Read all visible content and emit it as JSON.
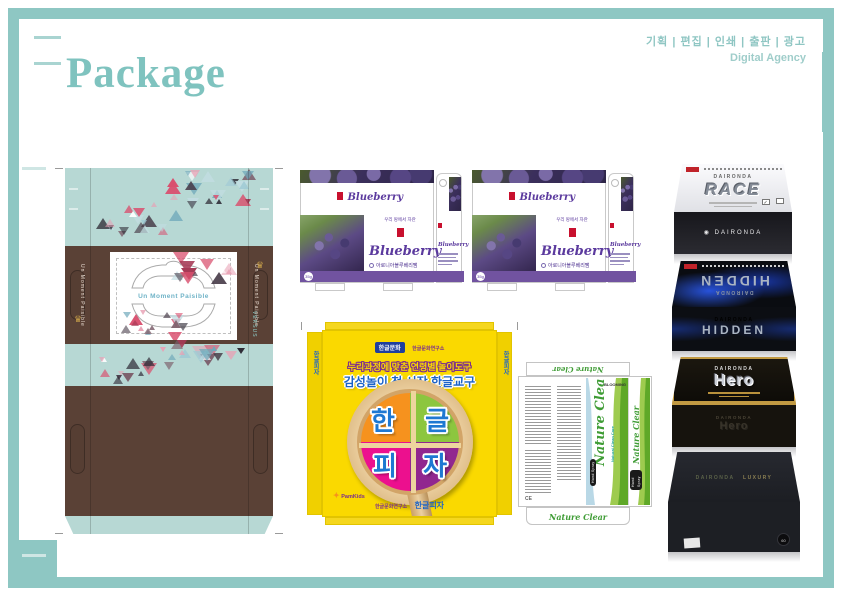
{
  "header": {
    "title": "Package",
    "services": "기획 | 편집 | 인쇄 | 출판 | 광고",
    "agency": "Digital Agency"
  },
  "palette": {
    "frame": "#8ec7c3",
    "brown": "#5a4136",
    "mint": "#b7d8d4",
    "purple": "#7153a0",
    "yellow": "#fad900",
    "triangle_colors": [
      "#d94f6e",
      "#a63a56",
      "#463a47",
      "#2e2a35",
      "#9fc9d4",
      "#6fa8ba",
      "#c2dde2",
      "#7c5e6b",
      "#e8a0b4",
      "#ffffff"
    ]
  },
  "left_package": {
    "center_text": "Un Moment Paisible",
    "side_text": "Un Moment Paisible",
    "corner_label": "VERSUS",
    "crown_icon": "♛"
  },
  "blueberry_package": {
    "tagline": "우리 땅에서 자란",
    "name": "Blueberry",
    "options": [
      "아로니아블루베리쨈",
      "블루베리쨈"
    ],
    "weight": "35g"
  },
  "pizza_package": {
    "badge": "한글문화",
    "badge_note": "한글문화연구소",
    "headline1": "누리과정에 맞춘 연령별 놀이도구",
    "headline2": "감성놀이 첫 시작 한글교구",
    "letters": [
      "한",
      "글",
      "피",
      "자"
    ],
    "logo_star": "✦",
    "logo": "PamKids",
    "footer_note": "한글문화연구소",
    "footer_name": "한글피자",
    "side_label": "한글피자"
  },
  "nature_package": {
    "name": "Nature Clear",
    "subtitle": "Natural Clean Care",
    "label": "Hand Spray",
    "brand": "▲ BLOOMING",
    "ce_mark": "CE"
  },
  "products": {
    "brand": "DAIRONDA",
    "front_logo": "◉ DAIRONDA",
    "check_icon": "✓",
    "items": [
      {
        "name": "RACE"
      },
      {
        "name": "HIDDEN"
      },
      {
        "name": "Hero"
      },
      {
        "name": "LUXURY"
      }
    ],
    "luxury_badge": "60"
  }
}
